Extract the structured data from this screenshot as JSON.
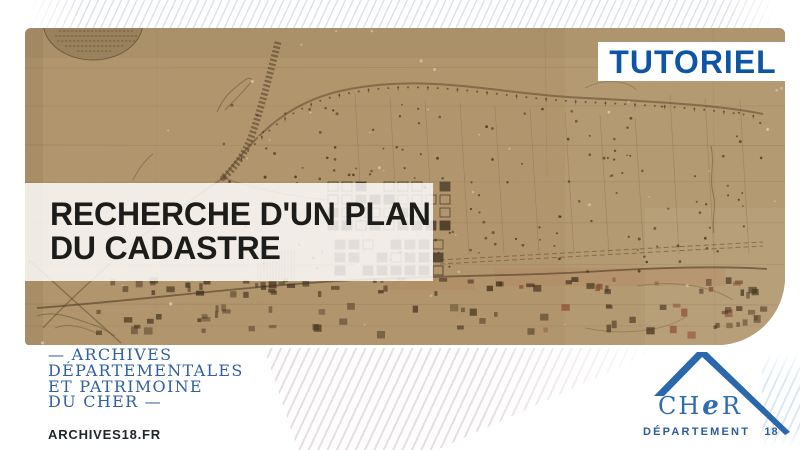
{
  "badge": {
    "label": "TUTORIEL",
    "text_color": "#0f55a5",
    "bg_color": "#ffffff"
  },
  "title": {
    "line1": "RECHERCHE D'UN PLAN",
    "line2": "DU CADASTRE",
    "text_color": "#1c1c1a"
  },
  "map": {
    "kind": "antique-cadastral-plan",
    "paper_color": "#b1966d",
    "ink_color": "#4e3b26"
  },
  "footer": {
    "org_lines": [
      "— ARCHIVES",
      "DÉPARTEMENTALES",
      "ET PATRIMOINE",
      "DU CHER —"
    ],
    "org_color": "#31609f",
    "website": "ARCHIVES18.FR",
    "website_color": "#20262c",
    "logo": {
      "ch": "CH",
      "e": "e",
      "r": "R",
      "caption": "DÉPARTEMENT",
      "number": "18",
      "color": "#2b62a6"
    }
  }
}
